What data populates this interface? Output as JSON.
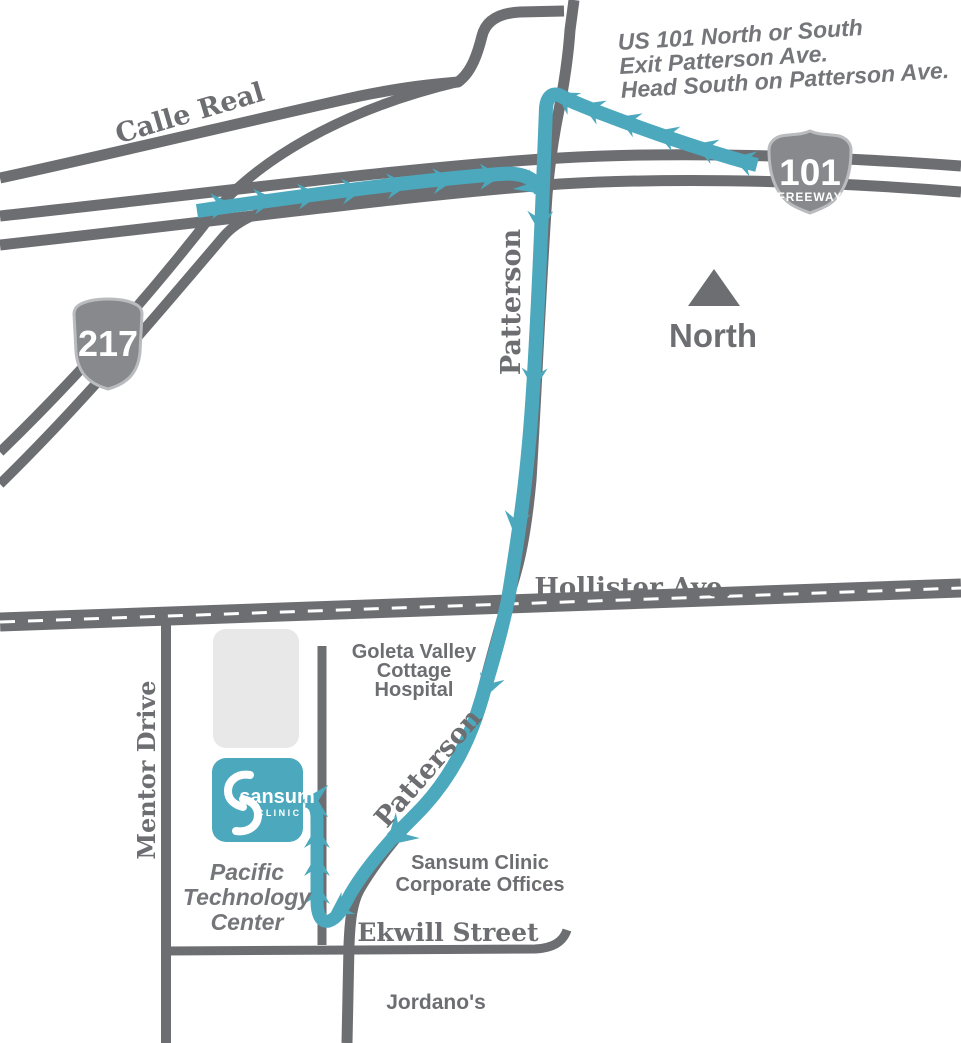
{
  "map": {
    "directions": {
      "line1": "US 101 North or South",
      "line2": "Exit Patterson Ave.",
      "line3": "Head South on Patterson Ave."
    },
    "labels": {
      "calle_real": "Calle Real",
      "patterson_upper": "Patterson",
      "patterson_lower": "Patterson",
      "hollister": "Hollister Ave.",
      "mentor_drive": "Mentor Drive",
      "ekwill": "Ekwill Street",
      "jordanos": "Jordano's",
      "north": "North"
    },
    "shields": {
      "freeway": {
        "number": "101",
        "caption": "FREEWAY"
      },
      "state": {
        "number": "217"
      }
    },
    "places": {
      "hospital": {
        "line1": "Goleta Valley",
        "line2": "Cottage",
        "line3": "Hospital"
      },
      "corporate": {
        "line1": "Sansum Clinic",
        "line2": "Corporate Offices"
      },
      "tech_center": {
        "line1": "Pacific",
        "line2": "Technology",
        "line3": "Center"
      }
    },
    "logo": {
      "name": "sansum",
      "sub": "C L I N I C"
    },
    "colors": {
      "route": "#4BA8BD",
      "road": "#6D6E71",
      "text": "#6D6E71",
      "building": "#E8E8E9",
      "shield": "#87898C"
    }
  }
}
